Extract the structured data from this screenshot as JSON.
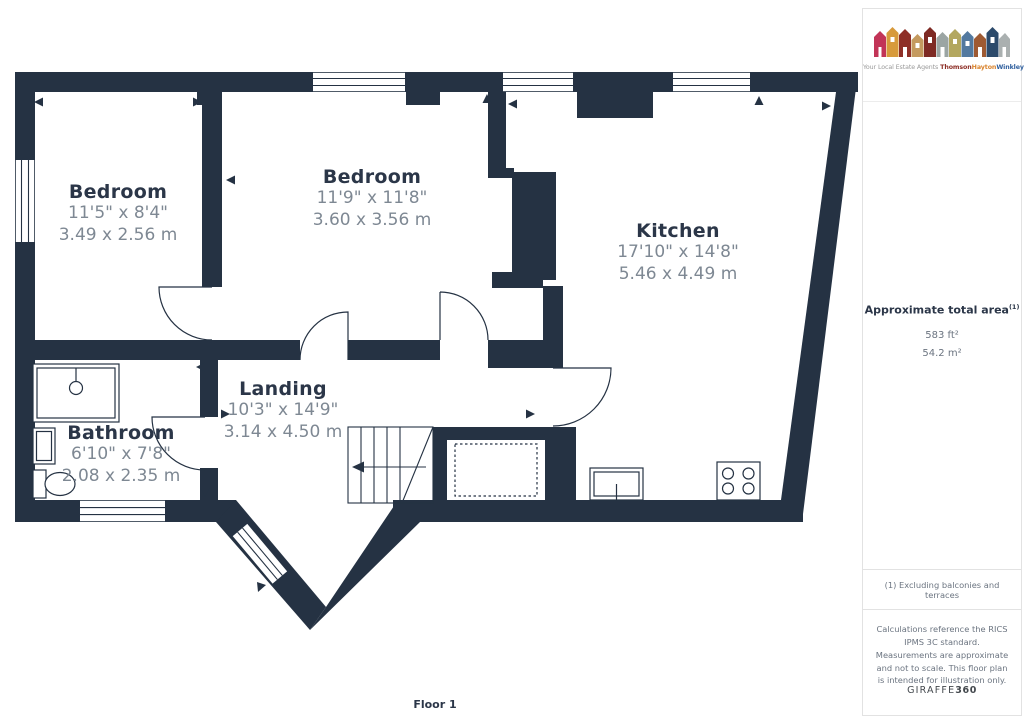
{
  "floorplan": {
    "floor_label": "Floor 1",
    "wall_color": "#253243",
    "room_name_color": "#2b3648",
    "room_dims_color": "#7e8893",
    "rooms": [
      {
        "name": "Bedroom",
        "dims_imperial": "11'5\" x 8'4\"",
        "dims_metric": "3.49 x 2.56 m"
      },
      {
        "name": "Bedroom",
        "dims_imperial": "11'9\" x 11'8\"",
        "dims_metric": "3.60 x 3.56 m"
      },
      {
        "name": "Kitchen",
        "dims_imperial": "17'10\" x 14'8\"",
        "dims_metric": "5.46 x 4.49 m"
      },
      {
        "name": "Landing",
        "dims_imperial": "10'3\" x 14'9\"",
        "dims_metric": "3.14 x 4.50 m"
      },
      {
        "name": "Bathroom",
        "dims_imperial": "6'10\" x 7'8\"",
        "dims_metric": "2.08 x 2.35 m"
      }
    ],
    "fixtures": [
      "stairs",
      "shower",
      "wash-basin",
      "toilet",
      "kitchen-sink",
      "hob",
      "storage-outline",
      "windows",
      "doors"
    ]
  },
  "sidebar": {
    "logo": {
      "tagline_prefix": "Your Local Estate Agents",
      "brand_parts": [
        {
          "text": "Thomson",
          "color": "#8e2f27"
        },
        {
          "text": "Hayton",
          "color": "#d9822b"
        },
        {
          "text": "Winkley",
          "color": "#2f5f9e"
        }
      ]
    },
    "area": {
      "title": "Approximate total area",
      "superscript": "(1)",
      "imperial": "583 ft²",
      "metric": "54.2 m²"
    },
    "note": "(1) Excluding balconies and terraces",
    "disclaimer": "Calculations reference the RICS IPMS 3C standard. Measurements are approximate and not to scale. This floor plan is intended for illustration only.",
    "brand_footer": {
      "name": "GIRAFFE",
      "suffix": "360"
    }
  }
}
